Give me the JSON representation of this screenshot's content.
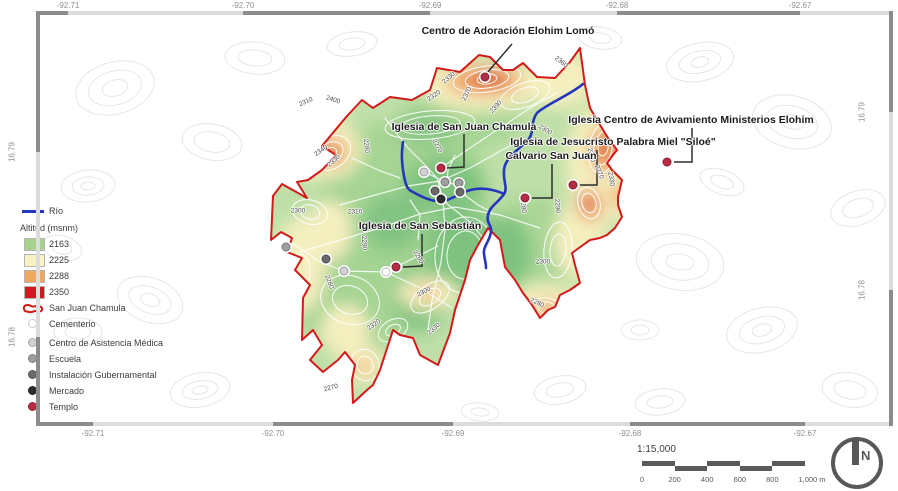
{
  "axes": {
    "top": [
      "-92.71",
      "-92.70",
      "-92.69",
      "-92.68",
      "-92.67"
    ],
    "bottom": [
      "-92.71",
      "-92.70",
      "-92.69",
      "-92.68",
      "-92.67"
    ],
    "left": [
      "16.79",
      "16.78"
    ],
    "right": [
      "16.79",
      "16.78"
    ]
  },
  "legend": {
    "rio_label": "Río",
    "altitude_title": "Altitud (msnm)",
    "altitude_classes": [
      {
        "value": "2163",
        "color": "#a9d18e"
      },
      {
        "value": "2225",
        "color": "#f8f2c4"
      },
      {
        "value": "2288",
        "color": "#f0a860"
      },
      {
        "value": "2350",
        "color": "#d2191f"
      }
    ],
    "boundary_label": "San Juan Chamula",
    "poi_classes": [
      {
        "label": "Cementerio",
        "color": "#ffffff"
      },
      {
        "label": "Centro de Asistencia Médica",
        "color": "#d2d2d2"
      },
      {
        "label": "Escuela",
        "color": "#9e9e9e"
      },
      {
        "label": "Instalación Gubernamental",
        "color": "#6a6a6a"
      },
      {
        "label": "Mercado",
        "color": "#2d2d2d"
      },
      {
        "label": "Templo",
        "color": "#b52c44"
      }
    ]
  },
  "map_labels": [
    "Centro de Adoración Elohim Lomó",
    "Iglesia de San Juan Chamula",
    "Iglesia Centro de Avivamiento Ministerios Elohim",
    "Iglesia de Jesucristo Palabra Miel \"Siloé\"",
    "Calvario San Juan",
    "Iglesia de San Sebastián"
  ],
  "contours": [
    "2310",
    "2400",
    "2330",
    "2320",
    "2370",
    "2390",
    "2360",
    "2300",
    "2280",
    "2340",
    "2330",
    "2270",
    "2310",
    "2300",
    "2290",
    "2260",
    "2260",
    "2300",
    "2280",
    "2350",
    "2330",
    "2270",
    "2280",
    "2290",
    "2320",
    "2300",
    "2330",
    "2270"
  ],
  "scalebar": {
    "ratio": "1:15,000",
    "ticks": [
      "0",
      "200",
      "400",
      "600",
      "800",
      "1,000 m"
    ]
  },
  "north_label": "N",
  "colors": {
    "frame_dark": "#8c8c8c",
    "frame_light": "#dcdcdc",
    "axis_text": "#8f8f8f",
    "boundary": "#d21a1a",
    "river": "#2536bd",
    "base_green": "#bfdfa8",
    "mid_green": "#a2d391",
    "dark_green": "#7fc27f",
    "pale_yellow": "#f5efbf",
    "orange": "#efa15c",
    "high_red": "#d2201f",
    "contour_outside": "#e6e6e6",
    "contour_label": "#4a4a4a",
    "label_text": "#1b1b1b",
    "connector": "#2e2e2e",
    "scalebar": "#5a5a5a",
    "north": "#585858",
    "legend_text": "#3c3c3c"
  }
}
